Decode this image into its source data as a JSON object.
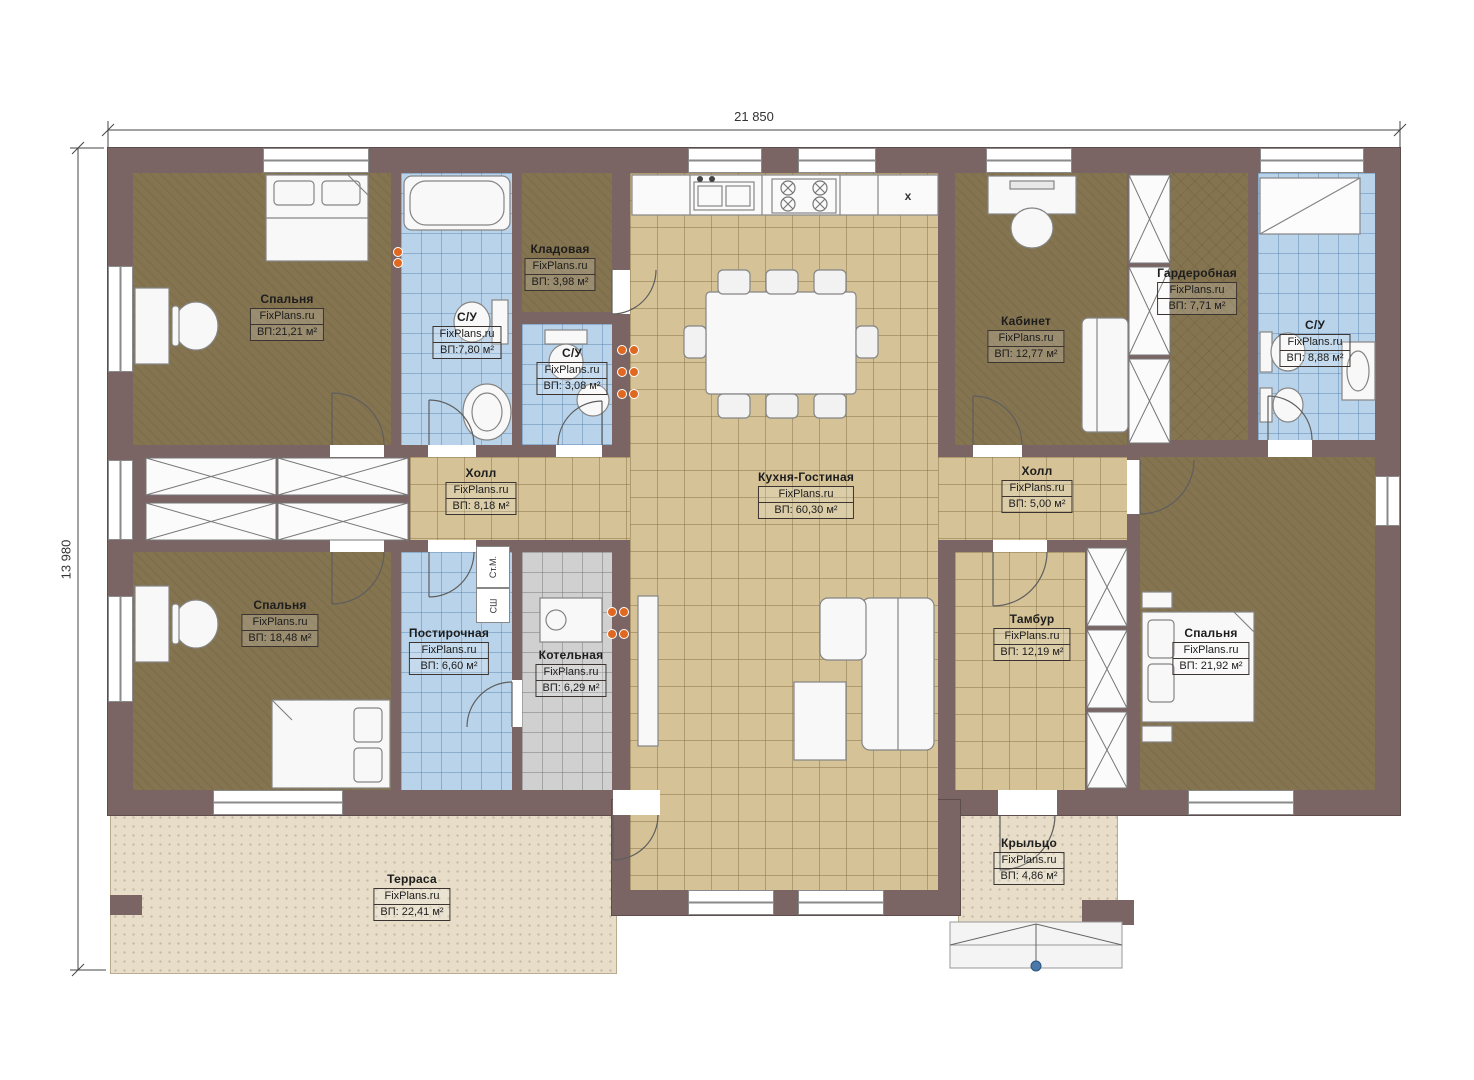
{
  "brand": "FixPlans.ru",
  "dimensions": {
    "width_label": "21 850",
    "height_label": "13 980"
  },
  "rooms": {
    "bedroom_tl": {
      "title": "Спальня",
      "area": "ВП:21,21 м²"
    },
    "wc_left": {
      "title": "С/У",
      "area": "ВП:7,80 м²"
    },
    "storage": {
      "title": "Кладовая",
      "area": "ВП: 3,98 м²"
    },
    "wc_small": {
      "title": "С/У",
      "area": "ВП: 3,08 м²"
    },
    "kitchen_living": {
      "title": "Кухня-Гостиная",
      "area": "ВП: 60,30 м²"
    },
    "office": {
      "title": "Кабинет",
      "area": "ВП: 12,77 м²"
    },
    "wardrobe": {
      "title": "Гардеробная",
      "area": "ВП: 7,71 м²"
    },
    "wc_tr": {
      "title": "С/У",
      "area": "ВП: 8,88 м²"
    },
    "hall_left": {
      "title": "Холл",
      "area": "ВП: 8,18 м²"
    },
    "hall_right": {
      "title": "Холл",
      "area": "ВП: 5,00 м²"
    },
    "bedroom_bl": {
      "title": "Спальня",
      "area": "ВП: 18,48 м²"
    },
    "laundry": {
      "title": "Постирочная",
      "area": "ВП: 6,60 м²"
    },
    "boiler": {
      "title": "Котельная",
      "area": "ВП: 6,29 м²"
    },
    "vestibule": {
      "title": "Тамбур",
      "area": "ВП: 12,19 м²"
    },
    "bedroom_r": {
      "title": "Спальня",
      "area": "ВП: 21,92 м²"
    },
    "terrace": {
      "title": "Терраса",
      "area": "ВП: 22,41 м²"
    },
    "porch": {
      "title": "Крыльцо",
      "area": "ВП: 4,86 м²"
    }
  },
  "annotations": {
    "washer": "Ст.М.",
    "dryer": "СШ",
    "fridge": "x"
  },
  "colors": {
    "wall": "#7a6464",
    "floor_wood": "#857450",
    "floor_tile_tan": "#d5c297",
    "floor_tile_blue": "#b9d4ea",
    "floor_tile_gray": "#d0d0d0",
    "terrace": "#e7ddc8",
    "marker_orange": "#e06820"
  }
}
